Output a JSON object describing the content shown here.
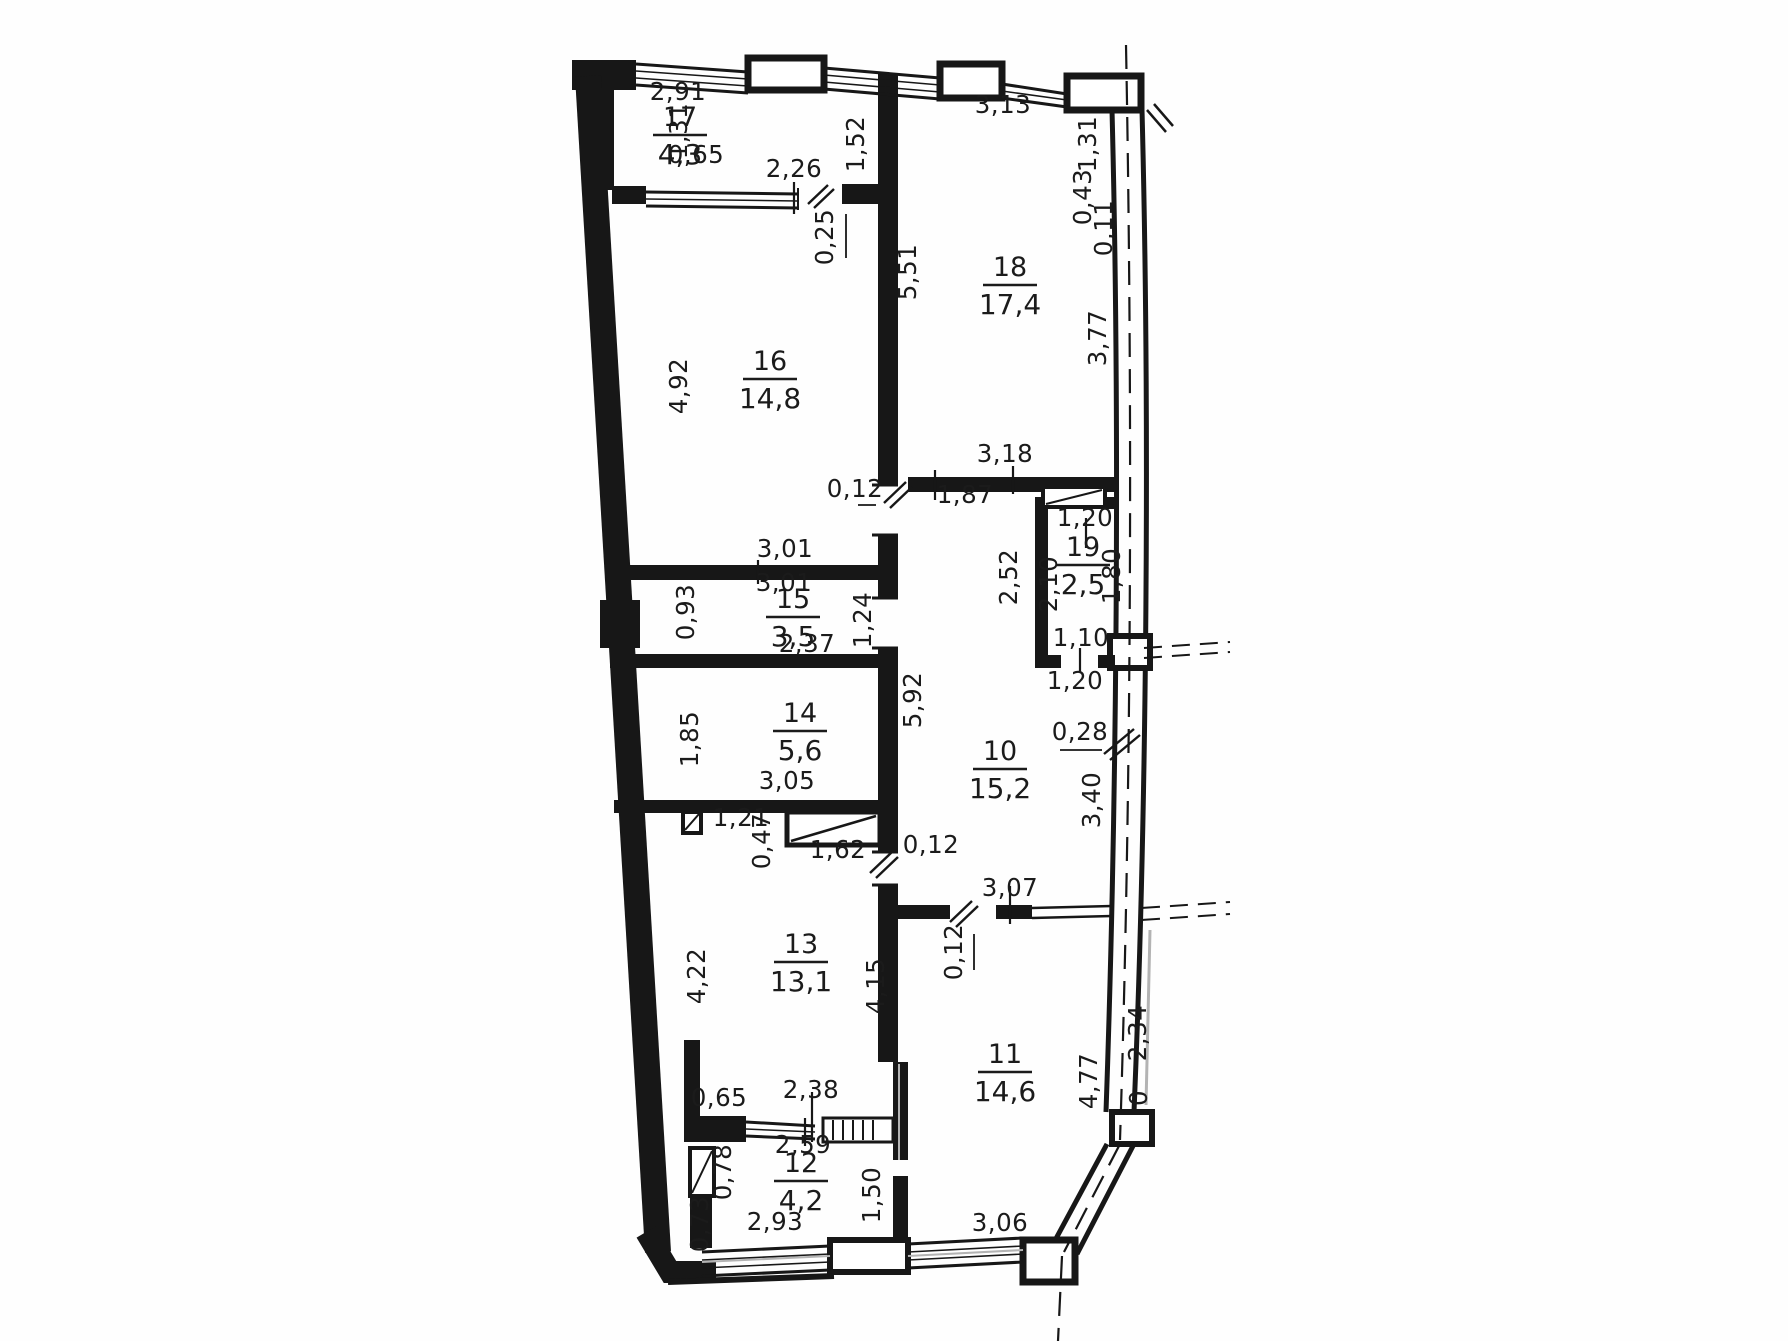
{
  "drawing": {
    "kind": "apartment floor plan (scanned blueprint)",
    "units": "meters",
    "ink_color": "#171717",
    "paper_color": "#fefefe"
  },
  "rooms": [
    {
      "no": "17",
      "area": "4,3",
      "x": 680,
      "y": 126
    },
    {
      "no": "18",
      "area": "17,4",
      "x": 1010,
      "y": 276
    },
    {
      "no": "16",
      "area": "14,8",
      "x": 770,
      "y": 370
    },
    {
      "no": "15",
      "area": "3,5",
      "x": 793,
      "y": 608
    },
    {
      "no": "19",
      "area": "2,5",
      "x": 1083,
      "y": 556
    },
    {
      "no": "14",
      "area": "5,6",
      "x": 800,
      "y": 722
    },
    {
      "no": "10",
      "area": "15,2",
      "x": 1000,
      "y": 760
    },
    {
      "no": "13",
      "area": "13,1",
      "x": 801,
      "y": 953
    },
    {
      "no": "11",
      "area": "14,6",
      "x": 1005,
      "y": 1063
    },
    {
      "no": "12",
      "area": "4,2",
      "x": 801,
      "y": 1172
    }
  ],
  "dimensions": [
    {
      "t": "2,91",
      "x": 678,
      "y": 100,
      "r": 0
    },
    {
      "t": "1,31",
      "x": 687,
      "y": 131,
      "r": -90
    },
    {
      "t": "0,65",
      "x": 696,
      "y": 163,
      "r": 0
    },
    {
      "t": "2,26",
      "x": 794,
      "y": 177,
      "r": 0
    },
    {
      "t": "1,52",
      "x": 864,
      "y": 144,
      "r": -90
    },
    {
      "t": "0,25",
      "x": 833,
      "y": 237,
      "r": -90
    },
    {
      "t": "3,13",
      "x": 1003,
      "y": 113,
      "r": 0
    },
    {
      "t": "1,31",
      "x": 1096,
      "y": 144,
      "r": -90
    },
    {
      "t": "0,43",
      "x": 1091,
      "y": 197,
      "r": -90
    },
    {
      "t": "0,11",
      "x": 1112,
      "y": 228,
      "r": -90
    },
    {
      "t": "5,51",
      "x": 916,
      "y": 272,
      "r": -90
    },
    {
      "t": "3,77",
      "x": 1106,
      "y": 338,
      "r": -90
    },
    {
      "t": "4,92",
      "x": 687,
      "y": 386,
      "r": -90
    },
    {
      "t": "3,18",
      "x": 1005,
      "y": 462,
      "r": 0
    },
    {
      "t": "0,12",
      "x": 855,
      "y": 497,
      "r": 0
    },
    {
      "t": "1,87",
      "x": 965,
      "y": 503,
      "r": 0
    },
    {
      "t": "1,20",
      "x": 1085,
      "y": 526,
      "r": 0
    },
    {
      "t": "2,52",
      "x": 1017,
      "y": 577,
      "r": -90
    },
    {
      "t": "2,10",
      "x": 1057,
      "y": 584,
      "r": -90
    },
    {
      "t": "1,80",
      "x": 1120,
      "y": 576,
      "r": -90
    },
    {
      "t": "3,01",
      "x": 785,
      "y": 557,
      "r": 0
    },
    {
      "t": "3,01",
      "x": 784,
      "y": 591,
      "r": 0
    },
    {
      "t": "0,93",
      "x": 694,
      "y": 612,
      "r": -90
    },
    {
      "t": "1,24",
      "x": 871,
      "y": 620,
      "r": -90
    },
    {
      "t": "2,37",
      "x": 807,
      "y": 652,
      "r": 0
    },
    {
      "t": "1,10",
      "x": 1081,
      "y": 646,
      "r": 0
    },
    {
      "t": "1,20",
      "x": 1075,
      "y": 689,
      "r": 0
    },
    {
      "t": "1,85",
      "x": 698,
      "y": 739,
      "r": -90
    },
    {
      "t": "5,92",
      "x": 921,
      "y": 700,
      "r": -90
    },
    {
      "t": "3,05",
      "x": 787,
      "y": 789,
      "r": 0
    },
    {
      "t": "0,28",
      "x": 1080,
      "y": 740,
      "r": 0
    },
    {
      "t": "3,40",
      "x": 1100,
      "y": 800,
      "r": -90
    },
    {
      "t": "1,21",
      "x": 741,
      "y": 826,
      "r": 0
    },
    {
      "t": "0,47",
      "x": 770,
      "y": 841,
      "r": -90
    },
    {
      "t": "1,62",
      "x": 838,
      "y": 858,
      "r": 0
    },
    {
      "t": "0,12",
      "x": 931,
      "y": 853,
      "r": 0
    },
    {
      "t": "4,22",
      "x": 705,
      "y": 976,
      "r": -90
    },
    {
      "t": "4,15",
      "x": 884,
      "y": 986,
      "r": -90
    },
    {
      "t": "3,07",
      "x": 1010,
      "y": 896,
      "r": 0
    },
    {
      "t": "0,12",
      "x": 962,
      "y": 952,
      "r": -90
    },
    {
      "t": "4,77",
      "x": 1097,
      "y": 1081,
      "r": -90
    },
    {
      "t": "2,34",
      "x": 1146,
      "y": 1033,
      "r": -90
    },
    {
      "t": "0",
      "x": 1147,
      "y": 1098,
      "r": -90
    },
    {
      "t": "0,65",
      "x": 719,
      "y": 1106,
      "r": 0
    },
    {
      "t": "2,38",
      "x": 811,
      "y": 1098,
      "r": 0
    },
    {
      "t": "2,59",
      "x": 803,
      "y": 1153,
      "r": 0
    },
    {
      "t": "0,78",
      "x": 731,
      "y": 1172,
      "r": -90
    },
    {
      "t": "0,73",
      "x": 708,
      "y": 1224,
      "r": -90
    },
    {
      "t": "1,50",
      "x": 880,
      "y": 1195,
      "r": -90
    },
    {
      "t": "2,93",
      "x": 775,
      "y": 1230,
      "r": 0
    },
    {
      "t": "3,06",
      "x": 1000,
      "y": 1231,
      "r": 0
    }
  ]
}
